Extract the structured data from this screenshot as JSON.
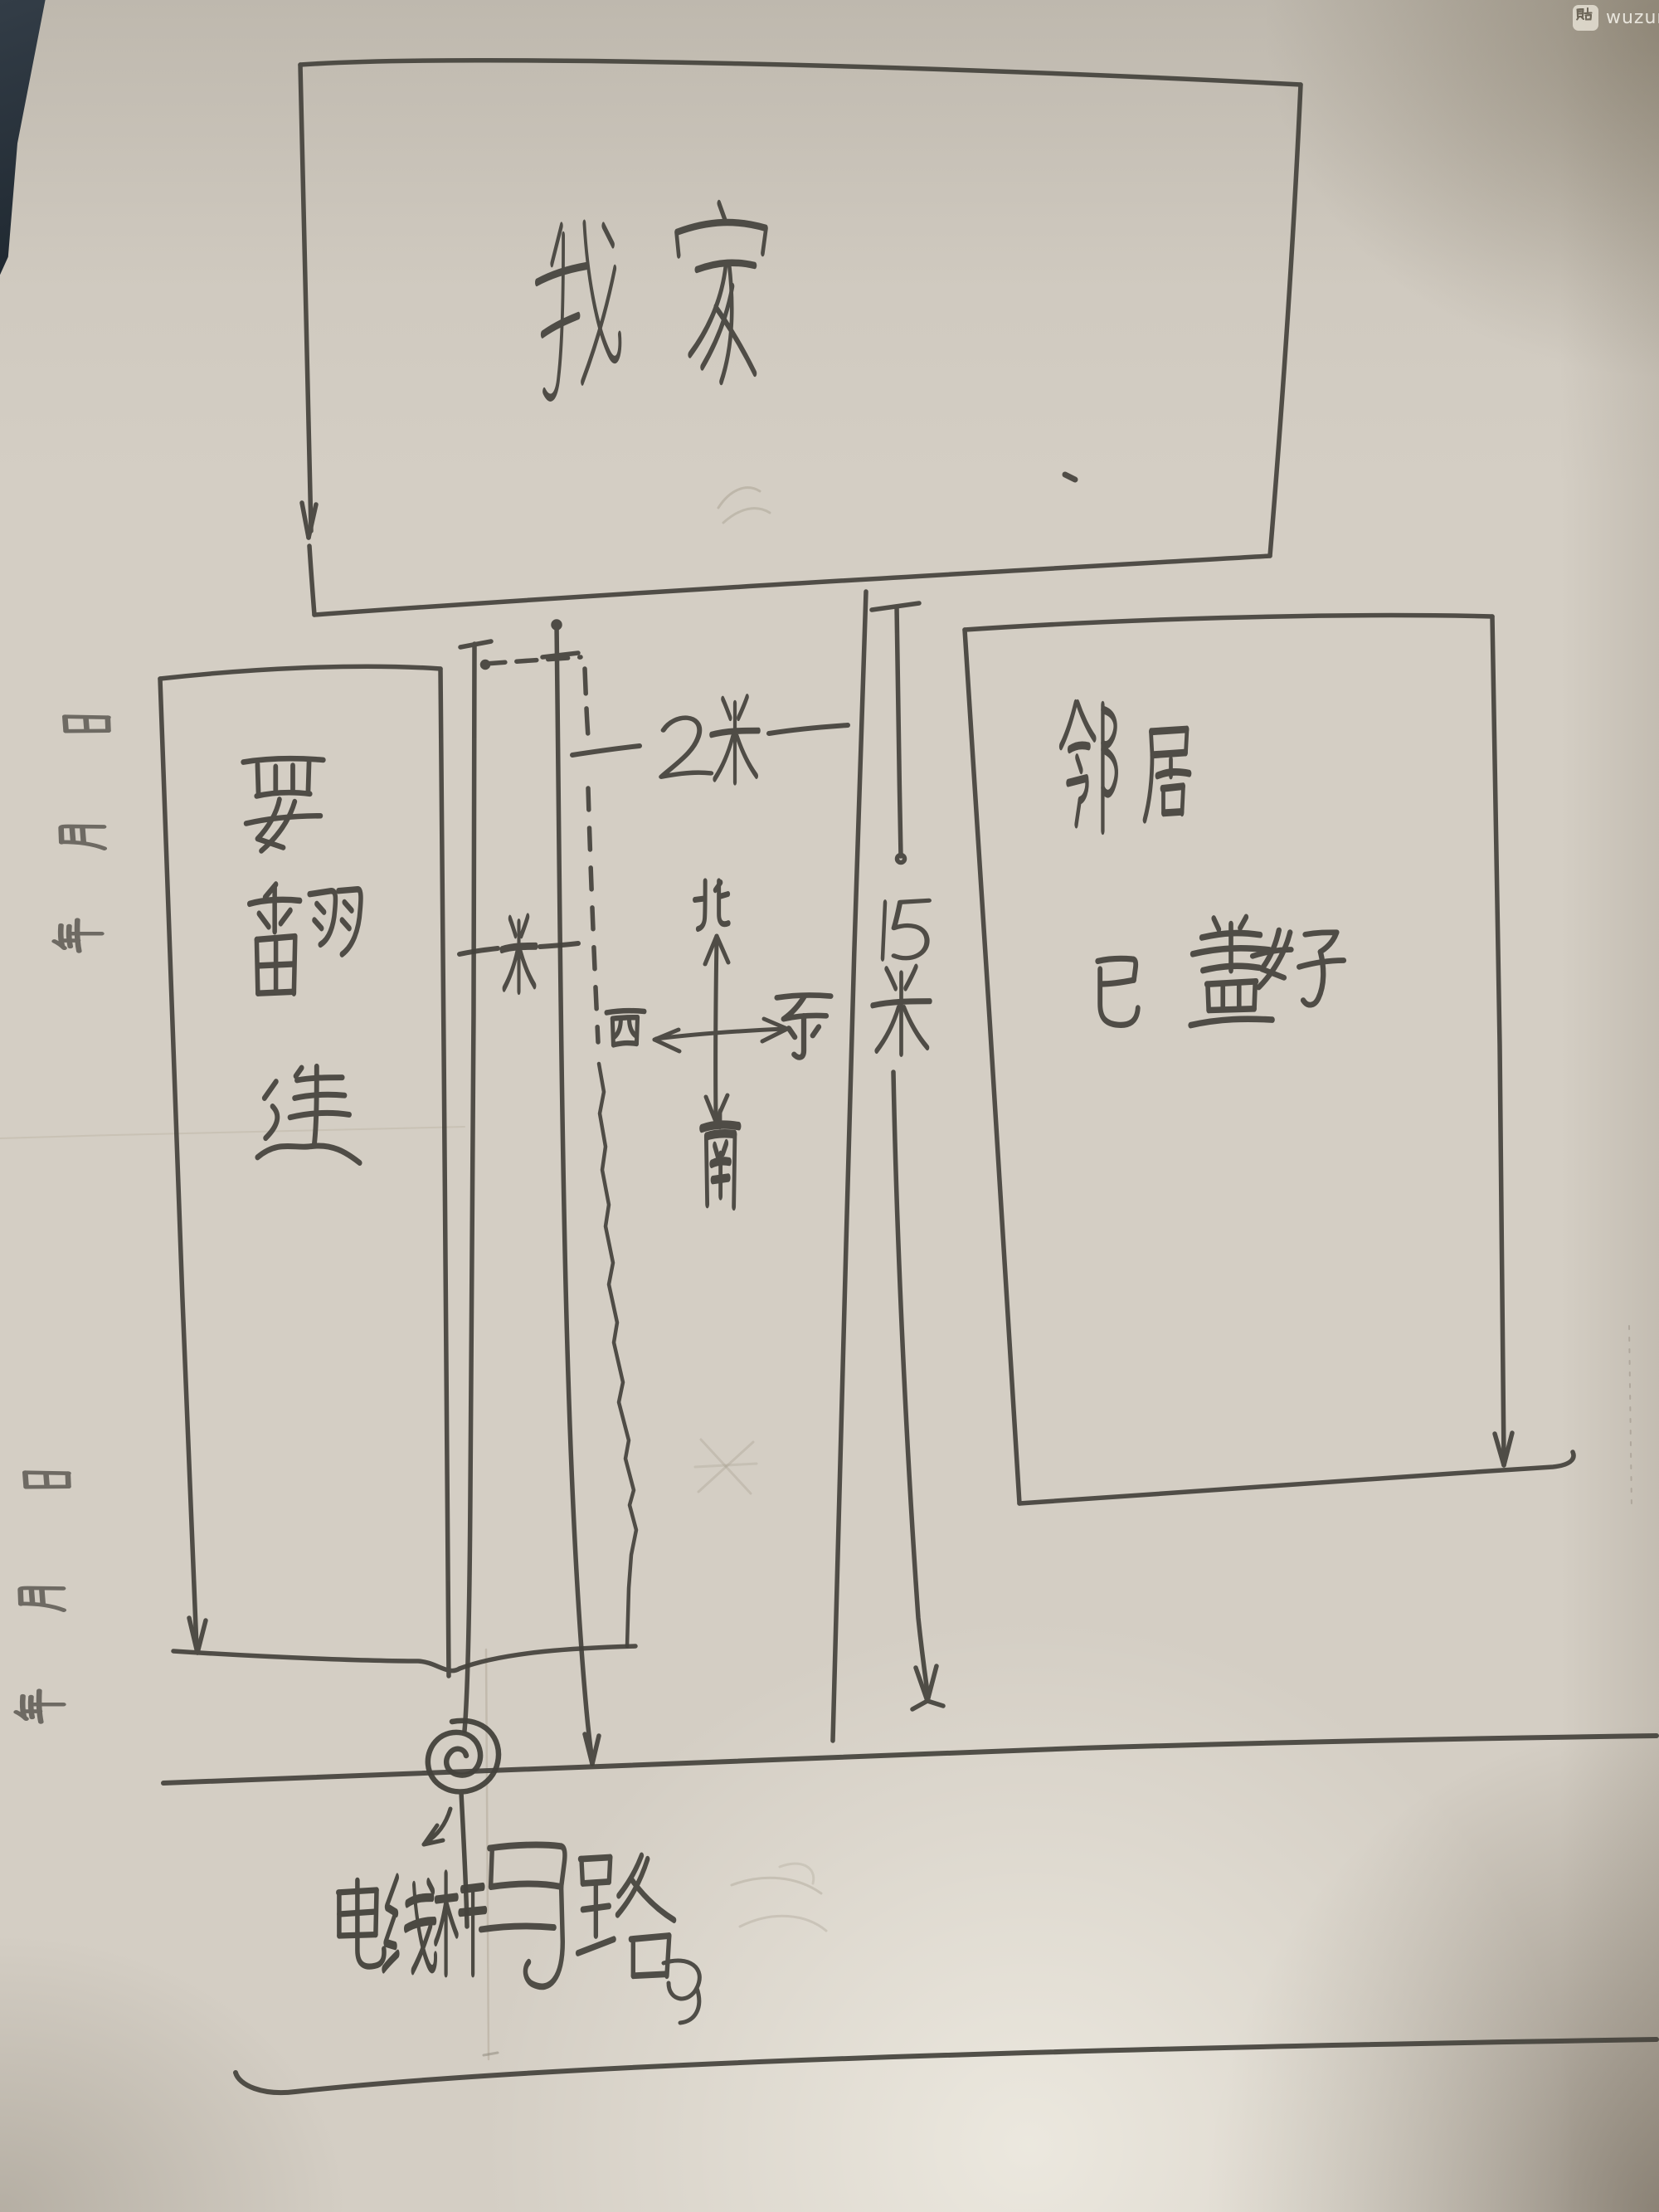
{
  "photo": {
    "background_color": "#27313a",
    "paper_color": "#d4cec4",
    "ink_color": "#44423c",
    "pencil_color": "#a79f90"
  },
  "watermark": {
    "logo_char": "贴",
    "text": "wuzung"
  },
  "paper_margin_print": {
    "fields": [
      "年",
      "月",
      "日"
    ],
    "sets_visible": 2,
    "orientation": "rotated-90"
  },
  "sketch": {
    "my_home": {
      "label": "我家"
    },
    "rebuild_strip": {
      "label": "要翻建"
    },
    "neighbor": {
      "name": "邻居",
      "status": "已盖好"
    },
    "dimensions": {
      "west_gap": "一米",
      "middle_gap": "2米",
      "neighbor_distance": "15米"
    },
    "compass": {
      "north": "北",
      "south": "南",
      "west": "西",
      "east": "东"
    },
    "road": {
      "label": "马路"
    },
    "utility_pole": {
      "label": "电线杆"
    }
  }
}
